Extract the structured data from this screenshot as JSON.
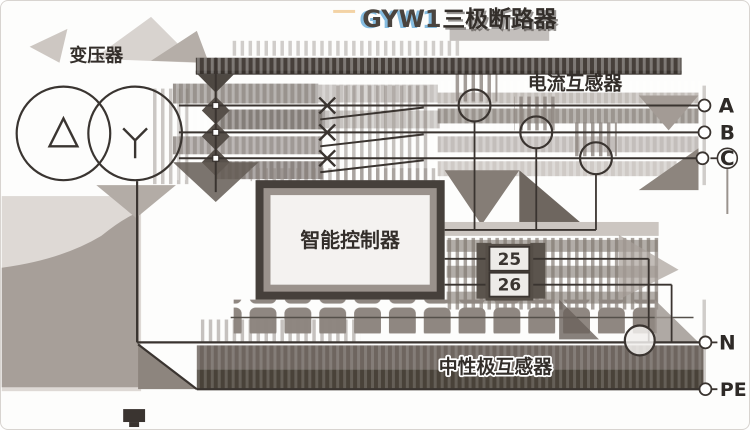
{
  "title": {
    "model": "GYW1",
    "name": "三极断路器"
  },
  "components": {
    "transformer": {
      "label": "变压器"
    },
    "current_transformer": {
      "label": "电流互感器"
    },
    "controller": {
      "label": "智能控制器"
    },
    "neutral_transformer": {
      "label": "中性极互感器"
    }
  },
  "terminals": {
    "phase_a": "A",
    "phase_b": "B",
    "phase_c": "C",
    "neutral": "N",
    "protective_earth": "PE",
    "terminal_25": "25",
    "terminal_26": "26"
  },
  "colors": {
    "line": "#3a3430",
    "dark_band": "#494239",
    "model_blue": "#85bce0",
    "artifact_gray": "#a79f99",
    "background": "#ffffff"
  }
}
